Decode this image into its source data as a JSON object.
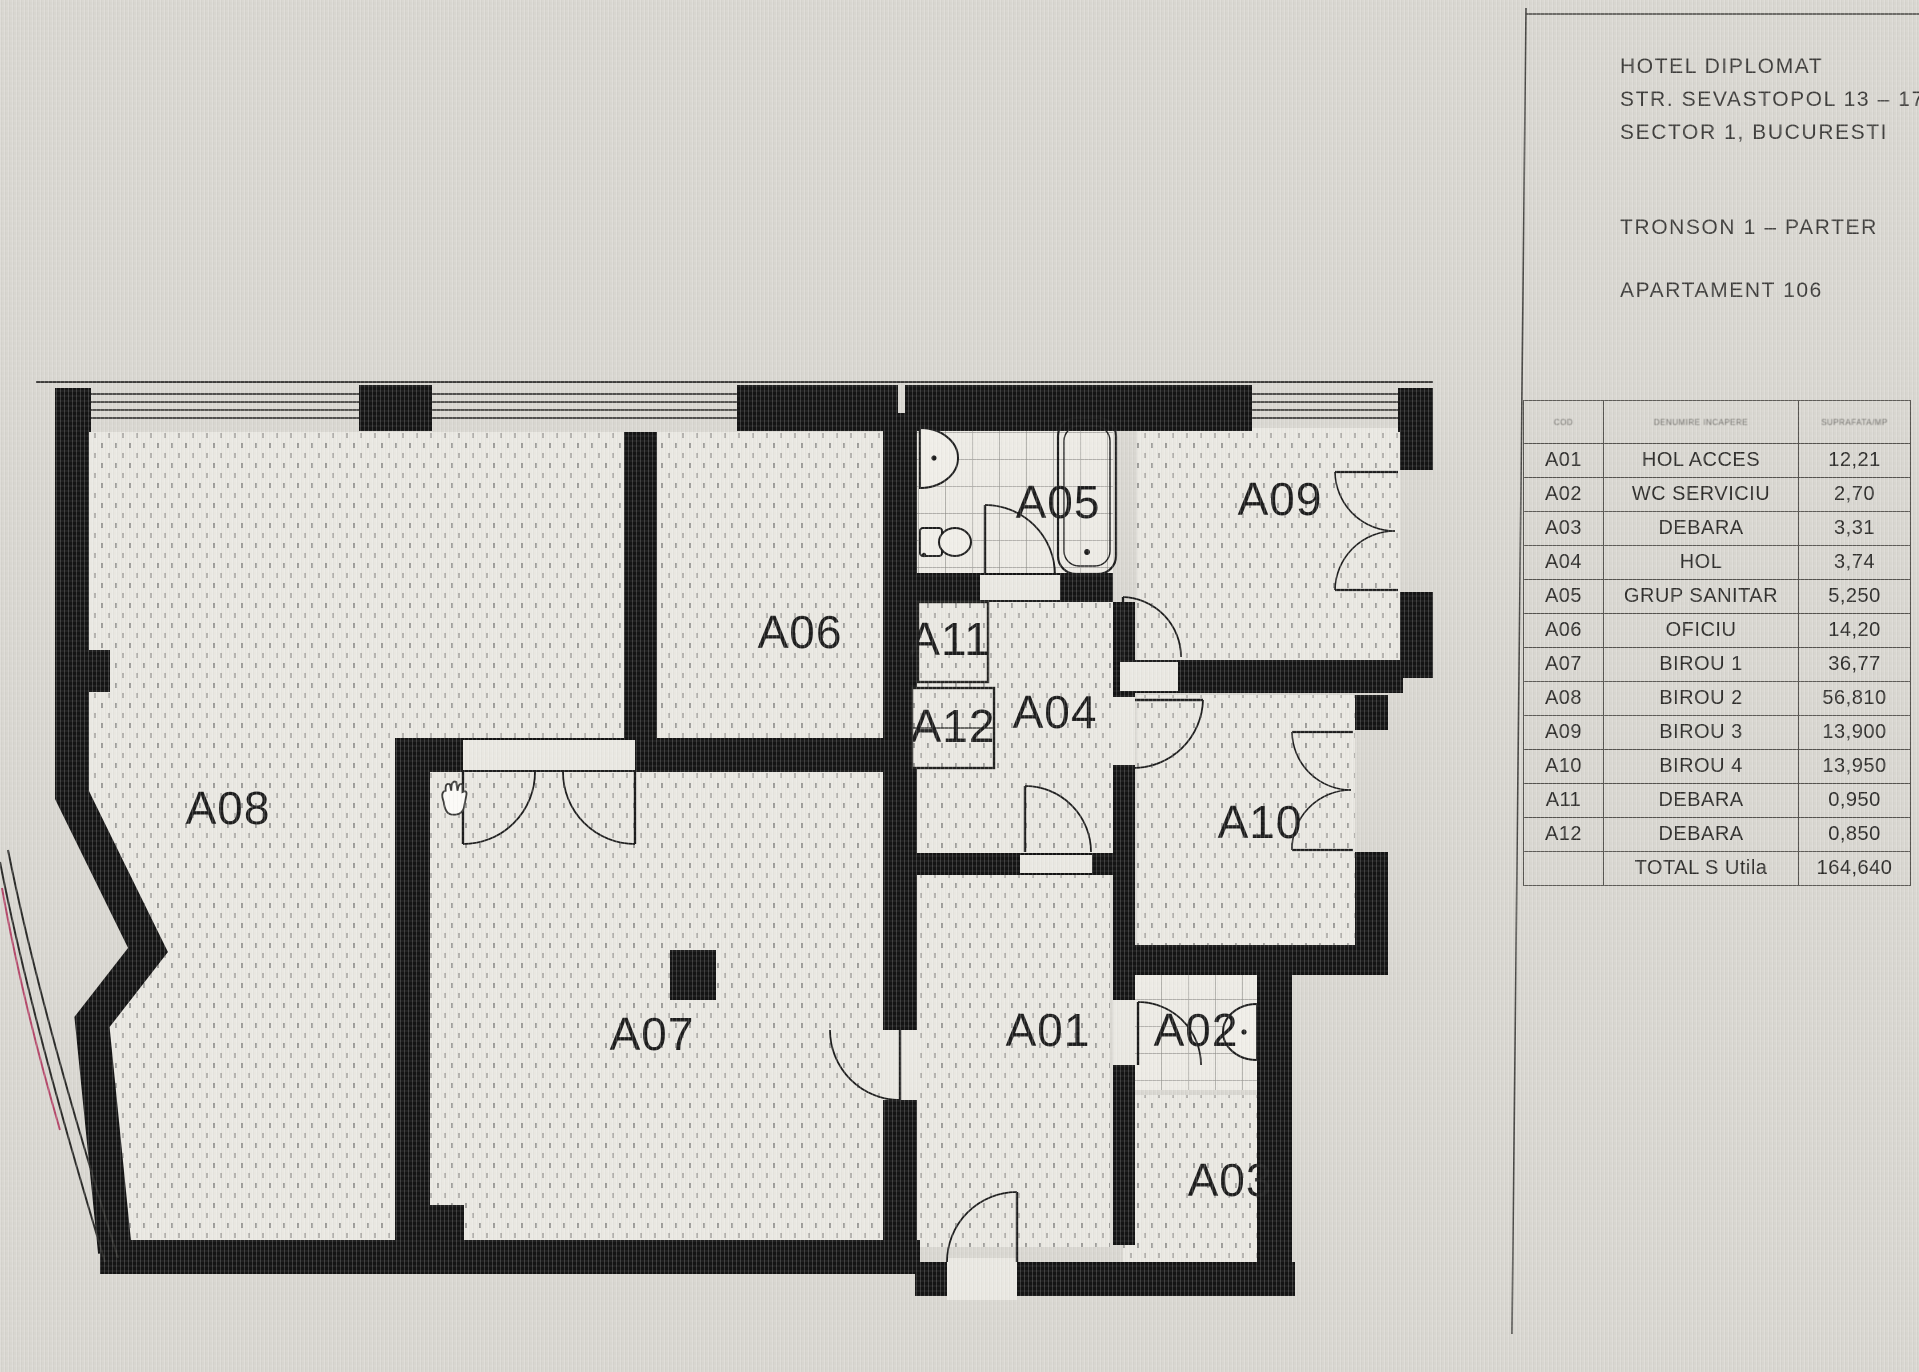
{
  "title_block": {
    "project": "HOTEL DIPLOMAT",
    "address": "STR. SEVASTOPOL 13 – 17",
    "city": "SECTOR 1, BUCURESTI",
    "section": "TRONSON 1 – PARTER",
    "apartment": "APARTAMENT 106"
  },
  "schedule": {
    "headers": [
      "COD",
      "DENUMIRE INCAPERE",
      "SUPRAFATA/MP"
    ],
    "rows": [
      [
        "A01",
        "HOL ACCES",
        "12,21"
      ],
      [
        "A02",
        "WC SERVICIU",
        "2,70"
      ],
      [
        "A03",
        "DEBARA",
        "3,31"
      ],
      [
        "A04",
        "HOL",
        "3,74"
      ],
      [
        "A05",
        "GRUP SANITAR",
        "5,250"
      ],
      [
        "A06",
        "OFICIU",
        "14,20"
      ],
      [
        "A07",
        "BIROU 1",
        "36,77"
      ],
      [
        "A08",
        "BIROU 2",
        "56,810"
      ],
      [
        "A09",
        "BIROU 3",
        "13,900"
      ],
      [
        "A10",
        "BIROU 4",
        "13,950"
      ],
      [
        "A11",
        "DEBARA",
        "0,950"
      ],
      [
        "A12",
        "DEBARA",
        "0,850"
      ]
    ],
    "total_label": "TOTAL S Utila",
    "total_value": "164,640"
  },
  "plan": {
    "labels": {
      "a01": "A01",
      "a02": "A02",
      "a03": "A03",
      "a04": "A04",
      "a05": "A05",
      "a06": "A06",
      "a07": "A07",
      "a08": "A08",
      "a09": "A09",
      "a10": "A10",
      "a11": "A11",
      "a12": "A12"
    },
    "cursor": "hand-cursor",
    "wall_color": "#141414",
    "floor_color": "#e9e7e1",
    "accent_curve_color": "#b4486a"
  }
}
